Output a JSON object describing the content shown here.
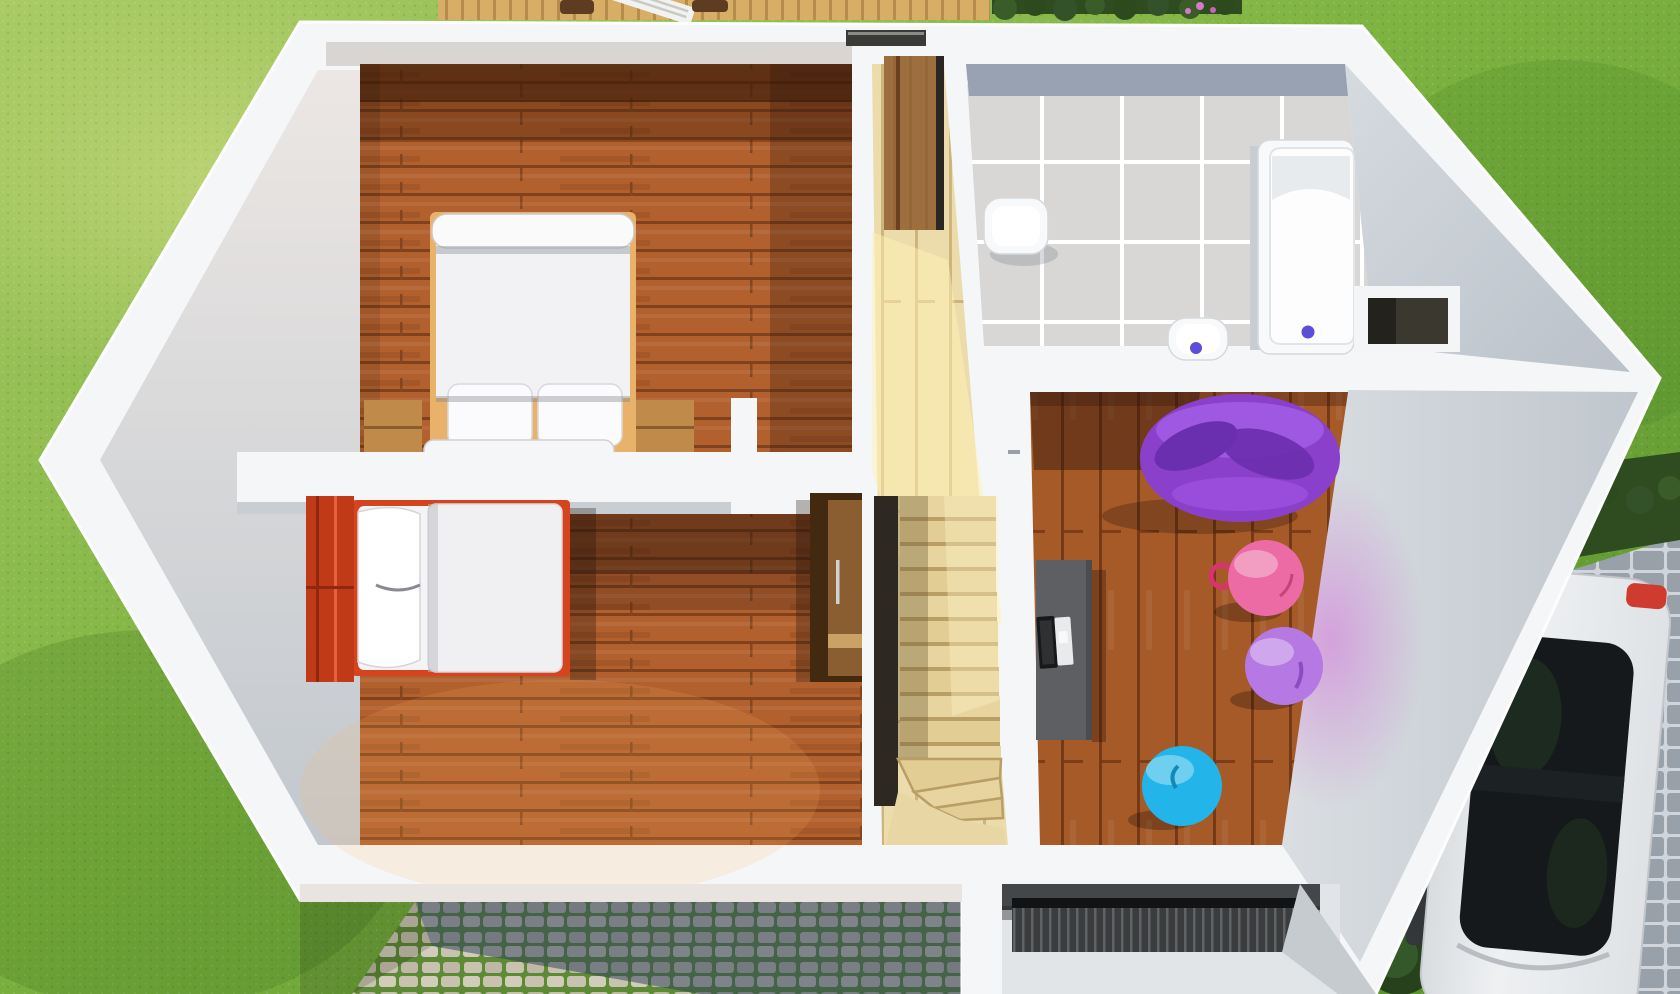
{
  "meta": {
    "title": "3D top-down floor plan render, upper storey of a house",
    "view": "dollhouse cutaway from above",
    "visible_text": ""
  },
  "colors": {
    "grass_light": "#aacb66",
    "grass_mid": "#7cb23f",
    "grass_dark": "#558e2b",
    "wall_white": "#f5f6f7",
    "wall_face_warm": "#ece7e4",
    "wall_face_gray": "#c2c8ce",
    "wall_face_inner": "#d8d5d2",
    "bedroom_floor": "#b2602e",
    "plank_line": "#7f421c",
    "playroom_floor": "#a65a28",
    "hall_floor": "#ecdcab",
    "stair_tread": "#e7d49e",
    "stair_void": "#2e2823",
    "tile": "#d8d7d5",
    "tile_dark_row": "#98a2b2",
    "grout": "#ffffff",
    "fixture_white": "#f8f9fa",
    "drain_blue": "#5b4fd8",
    "duvet_white": "#f2f2f4",
    "nightstand_oak": "#c08b4a",
    "bed2_red": "#d6431f",
    "headboard_red": "#c03a18",
    "wardrobe_dark": "#43290f",
    "wardrobe_front": "#8a5e30",
    "door_wood": "#8a5a30",
    "desk_gray": "#5d5f63",
    "laptop_dark": "#17181a",
    "beanbag_purple": "#8b40cc",
    "beanbag_fold": "#6a2fae",
    "beanbag_highlight": "#a660e8",
    "ball_pink": "#ec6ba4",
    "ball_purple": "#b678e2",
    "ball_blue": "#23b5ea",
    "cobble_stone": "#c9c2b0",
    "cobble_joint": "#5d8a34",
    "cobble_shadow": "#2c3c5a",
    "paver_stone": "#98a1a9",
    "paver_joint": "#cfd5da",
    "deck_wood": "#d8ae66",
    "hedge_green": "#2f4c20",
    "car_body": "#eef0f2",
    "car_glass": "#15191b",
    "car_taillight": "#cf3b2e",
    "mat_dark": "#3a3c3e"
  },
  "scene": {
    "environment": {
      "ground": "lawn",
      "walkway": "cobblestone-path",
      "driveway": "paver-driveway",
      "terrace": "wooden-deck",
      "hedges": [
        "top-hedge-with-pink-flowers",
        "driveway-hedge",
        "bushes-by-car"
      ]
    },
    "house": {
      "style": "white-walls cutaway, hexagonal footprint",
      "rooms": [
        {
          "id": "bedroom-1",
          "name": "master-bedroom",
          "floor": "hardwood-planks",
          "objects": [
            "double-bed",
            "pillow-left",
            "pillow-right",
            "duvet-roll",
            "bed-end-bench",
            "nightstand-left",
            "nightstand-right"
          ]
        },
        {
          "id": "bedroom-2",
          "name": "second-bedroom",
          "floor": "hardwood-planks",
          "objects": [
            "single-bed-red-frame",
            "crumpled-pillow",
            "white-duvet",
            "sideboard"
          ]
        },
        {
          "id": "stair-hall",
          "name": "stair-hall",
          "floor": "light-wood",
          "objects": [
            "winder-staircase",
            "stair-void",
            "wooden-door",
            "window-slot"
          ]
        },
        {
          "id": "bathroom",
          "name": "bathroom",
          "floor": "gray-tiles",
          "objects": [
            "wash-basin",
            "toilet",
            "bathtub",
            "wall-niche"
          ]
        },
        {
          "id": "playroom",
          "name": "playroom-office",
          "floor": "hardwood-planks",
          "objects": [
            "purple-bean-bag",
            "desk",
            "laptop",
            "pink-gym-ball-with-handle",
            "purple-gym-ball",
            "blue-gym-ball"
          ]
        }
      ],
      "entrance": {
        "porch": "recessed",
        "doormat": "ribbed-grate"
      }
    },
    "vehicle": {
      "type": "car",
      "color": "white",
      "roof": "dark-glass",
      "location": "driveway-bottom-right"
    }
  }
}
